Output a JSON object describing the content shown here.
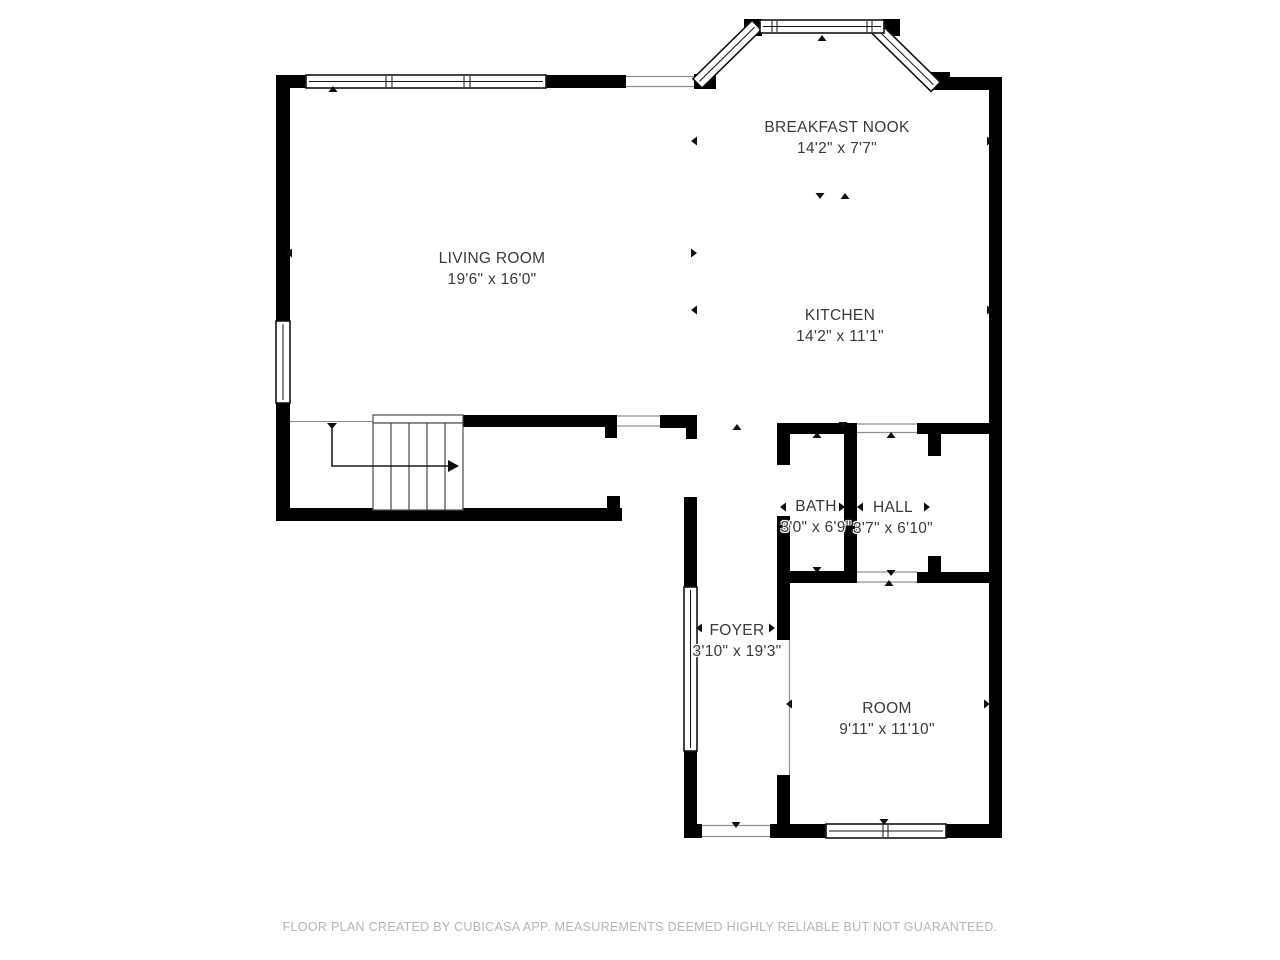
{
  "footer": "FLOOR PLAN CREATED BY CUBICASA APP. MEASUREMENTS DEEMED HIGHLY RELIABLE BUT NOT GUARANTEED.",
  "rooms": {
    "living_room": {
      "name": "LIVING ROOM",
      "dims": "19'6\" x 16'0\""
    },
    "breakfast_nook": {
      "name": "BREAKFAST NOOK",
      "dims": "14'2\" x 7'7\""
    },
    "kitchen": {
      "name": "KITCHEN",
      "dims": "14'2\" x 11'1\""
    },
    "bath": {
      "name": "BATH",
      "dims": "3'0\" x 6'9\""
    },
    "hall": {
      "name": "HALL",
      "dims": "3'7\" x 6'10\""
    },
    "foyer": {
      "name": "FOYER",
      "dims": "3'10\" x 19'3\""
    },
    "room": {
      "name": "ROOM",
      "dims": "9'11\" x 11'10\""
    }
  },
  "colors": {
    "wall": "#000000",
    "label_text": "#3a3a3a",
    "footer_text": "#b5b5b5",
    "opening_line": "#8f8f8f"
  }
}
